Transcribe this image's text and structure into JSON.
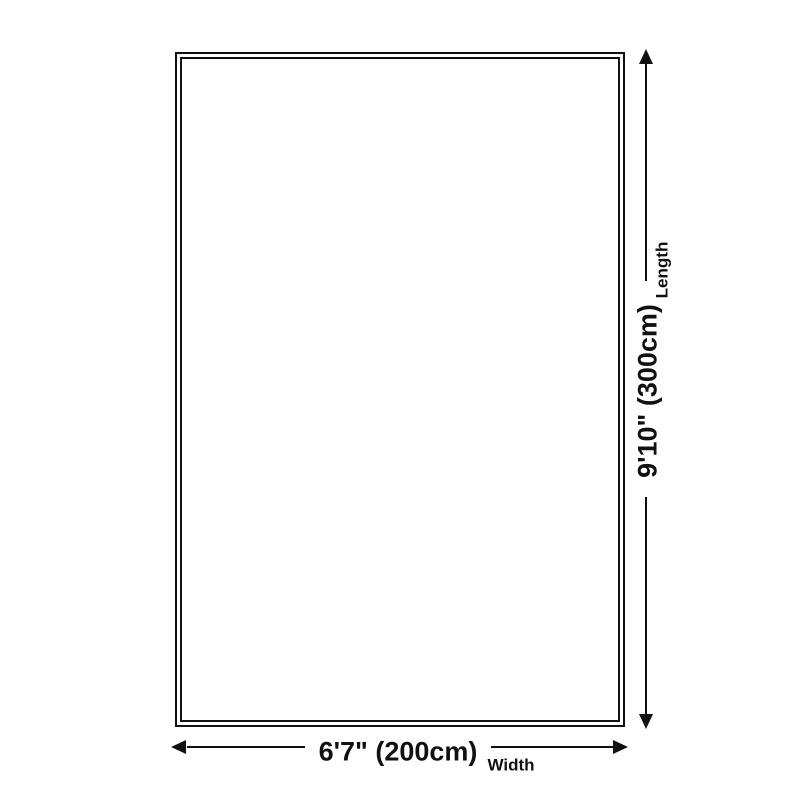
{
  "diagram": {
    "type": "product-dimension-diagram",
    "ink_color": "#111111",
    "background_color": "#ffffff",
    "rug": {
      "description": "empty rectangular outline with double border"
    },
    "length_dimension": {
      "value": "9'10\" (300cm)",
      "label": "Length",
      "orientation": "vertical",
      "side": "right"
    },
    "width_dimension": {
      "value": "6'7\" (200cm)",
      "label": "Width",
      "orientation": "horizontal",
      "side": "bottom"
    }
  }
}
